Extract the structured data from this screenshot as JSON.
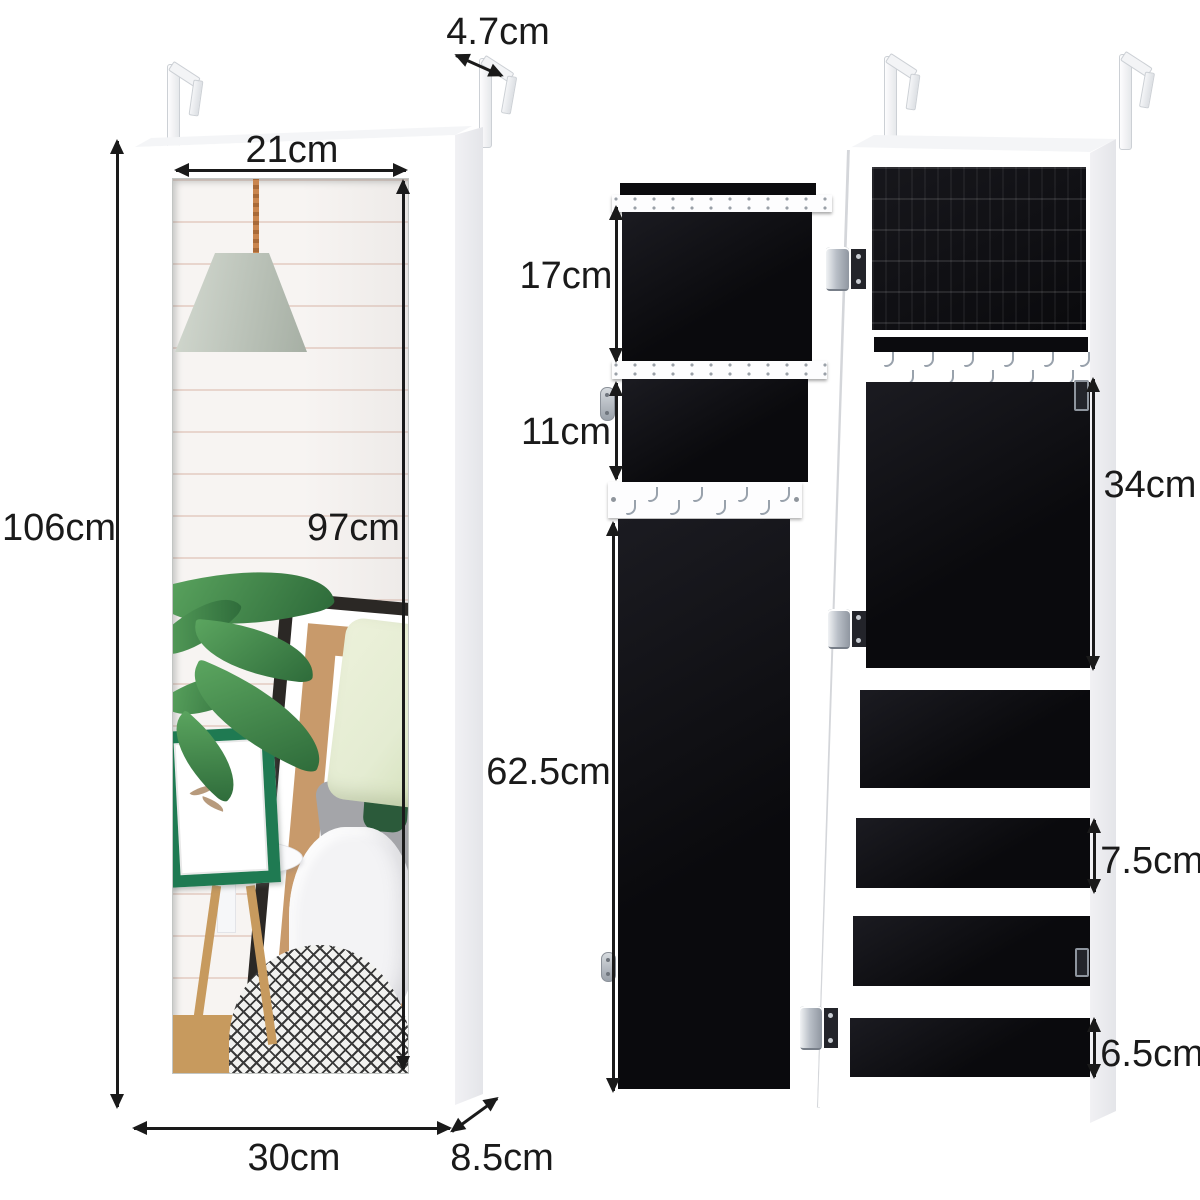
{
  "page": {
    "description": "Product dimension diagram of an over-door hanging jewelry armoire cabinet with mirror: closed front view with bedroom reflection (left) and open two-panel interior view (right)"
  },
  "units": {
    "closed": {
      "labels": {
        "hook_depth": "4.7cm",
        "mirror_width": "21cm",
        "height": "106cm",
        "mirror_height": "97cm",
        "width": "30cm",
        "depth": "8.5cm"
      },
      "mirror_scene": {
        "poster_letter": "k",
        "poster_letter_2": "t"
      }
    },
    "open": {
      "labels": {
        "earring_panel_height": "17cm",
        "upper_compartment_height": "11cm",
        "door_panel_height": "62.5cm",
        "necklace_panel_height": "34cm",
        "shelf_spacing": "7.5cm",
        "bottom_shelf_spacing": "6.5cm"
      }
    }
  },
  "icons": {
    "over-door-hanger": "z-shaped white metal bracket",
    "j-hook": "small curved silver hook",
    "hinge": "silver barrel hinge with dark mounting plate",
    "magnetic-catch": "oval silver catch plate",
    "dimension-arrow": "black double-headed measurement arrow"
  },
  "colors": {
    "page": "#ffffff",
    "arrow": "#1a1a1a",
    "cabinet-white": "#ffffff",
    "cabinet-edge": "#d5d8db",
    "velvet-black": "#0b0b0e",
    "strip-white": "#fdfdfe",
    "hook-metal": "#99a2ac",
    "hinge-plate": "#23242a",
    "brick-wall": "#f7f4f2",
    "mortar": "#e8d5cd",
    "kraft-mat": "#c89a6b",
    "frame-black": "#2b2825",
    "frame-green": "#1f7a52",
    "leaf-green": "#2e6b3a",
    "leaf-light": "#5ba55f",
    "pillow-light": "#e4ecd2",
    "pillow-dark": "#2b5a3a",
    "bed-grey": "#a4a5a9",
    "duvet-white": "#f3f3f5",
    "wood": "#c79a5e",
    "rope": "#c9854e"
  }
}
